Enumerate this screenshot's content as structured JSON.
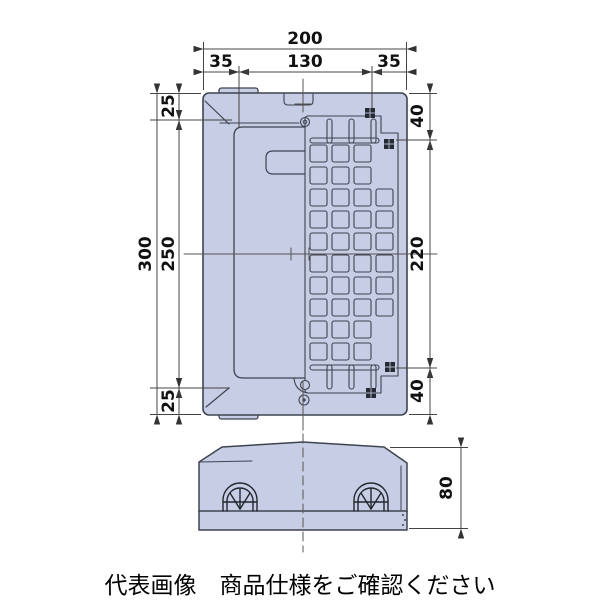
{
  "caption": "代表画像　商品仕様をご確認ください",
  "colors": {
    "body_fill": "#c6cde4",
    "outline": "#3e4450",
    "dim_line": "#4a4a4a",
    "dim_text": "#111111",
    "marker_fill": "#262b33",
    "marker_cross": "#aeb6cc"
  },
  "plan_view": {
    "dims": {
      "width_total": "200",
      "width_left": "35",
      "width_center": "130",
      "width_right": "35",
      "height_total": "300",
      "height_top": "25",
      "height_center": "250",
      "height_bottom": "25",
      "right_top": "40",
      "right_center": "220",
      "right_bottom": "40"
    },
    "grid": {
      "cols": 4,
      "rows": 10,
      "x0": 310,
      "y0": 145,
      "pitch": 22,
      "size": 17,
      "skip_last_col_rows": [
        0,
        1,
        8,
        9
      ],
      "teeth_x": [
        327,
        349,
        371
      ],
      "teeth_w": 5,
      "teeth_h": 24,
      "top_teeth_y": 119,
      "bottom_teeth_y": 365,
      "bar_top": [
        310,
        138,
        69,
        5
      ],
      "bar_bottom": [
        310,
        365,
        69,
        5
      ]
    }
  },
  "side_view": {
    "dims": {
      "height": "80"
    }
  }
}
